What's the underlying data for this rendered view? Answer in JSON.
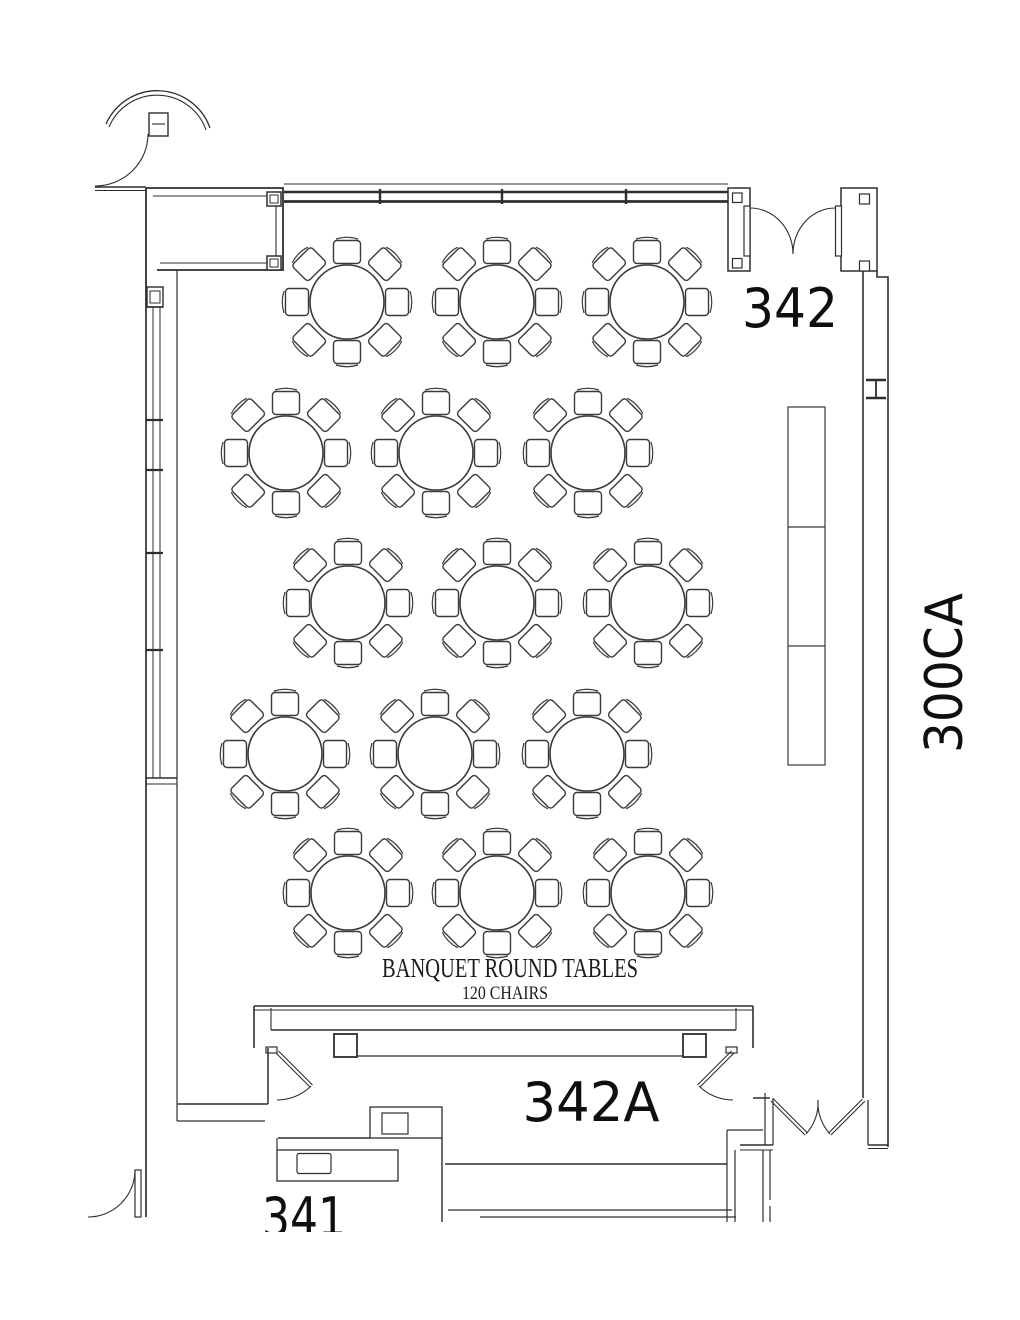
{
  "document": {
    "type": "architectural-floor-plan",
    "description": "Banquet room seating plan with round tables"
  },
  "rooms": {
    "main": {
      "number": "342"
    },
    "annex": {
      "number": "342A"
    },
    "lower": {
      "number": "341"
    },
    "corridor": {
      "number": "300CA"
    }
  },
  "annotation": {
    "title": "BANQUET ROUND TABLES",
    "subtitle": "120 CHAIRS"
  },
  "layout": {
    "table_count": 15,
    "chairs_per_table": 8,
    "total_chairs": 120,
    "table_radius_px": 37,
    "chair_orthogonal_offset": 50,
    "chair_diagonal_offset": 53.5,
    "table_positions": [
      [
        347,
        302
      ],
      [
        497,
        302
      ],
      [
        647,
        302
      ],
      [
        286,
        453
      ],
      [
        436,
        453
      ],
      [
        588,
        453
      ],
      [
        348,
        603
      ],
      [
        497,
        603
      ],
      [
        648,
        603
      ],
      [
        285,
        754
      ],
      [
        435,
        754
      ],
      [
        587,
        754
      ],
      [
        348,
        893
      ],
      [
        497,
        893
      ],
      [
        648,
        893
      ]
    ]
  },
  "colors": {
    "background": "#ffffff",
    "wall_line": "#2e2e2e",
    "furniture_line": "#3a3a3a",
    "text": "#0f0f0f"
  }
}
